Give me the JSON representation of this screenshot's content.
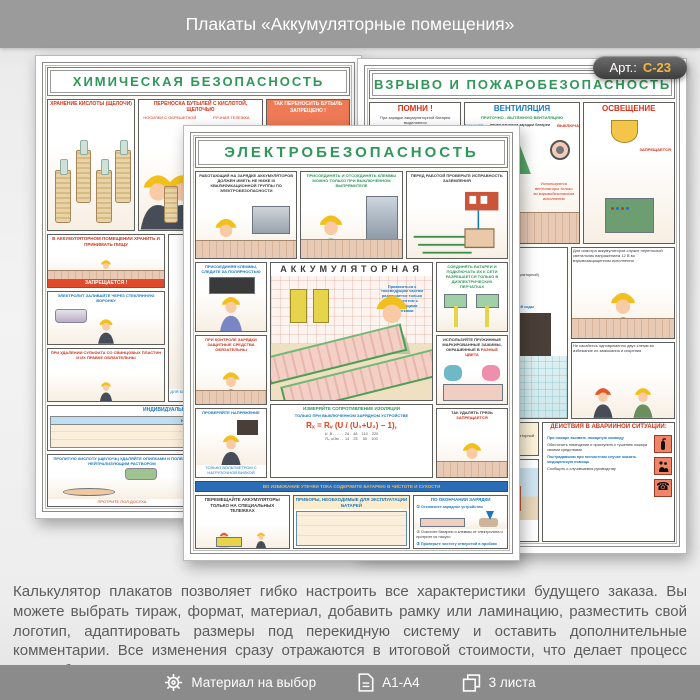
{
  "header": {
    "title": "Плакаты «Аккумуляторные помещения»"
  },
  "badge": {
    "prefix": "Арт.:",
    "code": "С-23"
  },
  "description": {
    "text": "Калькулятор плакатов позволяет гибко настроить все характеристики будущего заказа. Вы можете выбрать тираж, формат, материал, добавить рамку или ламинацию, разместить свой логотип, адаптировать размеры под перекидную систему и оставить дополнительные комментарии. Все изменения сразу отражаются в итоговой стоимости, что делает процесс заказа быстрым и прозрачным"
  },
  "footer": {
    "items": [
      {
        "icon": "gear-icon",
        "label": "Материал на выбор"
      },
      {
        "icon": "page-icon",
        "label": "А1-А4"
      },
      {
        "icon": "sheets-icon",
        "label": "3 листа"
      }
    ]
  },
  "posters": {
    "chemical": {
      "title": "ХИМИЧЕСКАЯ БЕЗОПАСНОСТЬ",
      "storage": {
        "title": "ХРАНЕНИЕ КИСЛОТЫ (ЩЕЛОЧИ)"
      },
      "carry": {
        "title": "ПЕРЕНОСКА БУТЫЛЕЙ С КИСЛОТОЙ, ЩЕЛОЧЬЮ",
        "sub1": "НОСИЛКИ С ОБРЕШЕТКОЙ",
        "sub2": "РУЧНАЯ ТЕЛЕЖКА"
      },
      "forbidden_carry": {
        "title": "ТАК ПЕРЕНОСИТЬ БУТЫЛЬ",
        "warn": "ЗАПРЕЩЕНО !"
      },
      "no_food": {
        "title": "В АККУМУЛЯТОРНОМ ПОМЕЩЕНИИ ХРАНИТЬ И ПРИНИМАТЬ ПИЩУ",
        "warn": "ЗАПРЕЩАЕТСЯ !"
      },
      "funnel": {
        "title": "ЭЛЕКТРОЛИТ ЗАЛИВАЙТЕ ЧЕРЕЗ СТЕКЛЯННУЮ ВОРОНКУ"
      },
      "sulfate": {
        "title": "ПРИ УДАЛЕНИИ СУЛЬФАТА СО СВИНЦОВЫХ ПЛАСТИН И ИХ ПРАВКЕ ОБЯЗАТЕЛЬНЫ"
      },
      "electrolyte": {
        "title": "ПРИГОТОВЛЕНИЕ ЭЛЕКТРОЛИТА",
        "sub": "КИСЛОТНОГО",
        "note": "ДЛЯ БЕЗОПАСНОГО СЛИВА КИСЛОТЫ (ЩЕЛОЧИ) ИСПОЛЬЗУЙТЕ СИФОН ИЛИ ПОДСТАВКУ ДЛЯ НАКЛОНА БУТЫЛИ"
      },
      "ppe": {
        "title": "ИНДИВИДУАЛЬНЫЕ ЗАЩИТНЫЕ СРЕДСТВА",
        "col": "НАИМЕНОВАНИЕ"
      },
      "spill": {
        "title": "ПРОЛИТУЮ КИСЛОТУ (ЩЕЛОЧЬ) УДАЛЯЙТЕ ОПИЛКАМИ И ПОЛЕЙТЕ НЕЙТРАЛИЗУЮЩИМ РАСТВОРОМ",
        "note": "ПРОТРИТЕ ПОЛ ДОСУХА"
      },
      "waste": {
        "title": "ОТРАБОТАННЫЙ ЭЛЕКТРОЛИТ СЛИВАЙТЕ В СПЕЦИАЛЬНУЮ ЕМКОСТЬ И ОТПРАВЬТЕ НА НЕЙТРАЛИЗАЦИЮ"
      }
    },
    "fire": {
      "title": "ВЗРЫВО И ПОЖАРОБЕЗОПАСНОСТЬ",
      "remember": {
        "title": "ПОМНИ !",
        "text": "При зарядке аккумуляторной батареи выделяются",
        "cloud1": "Вредные пары серной кислоты",
        "cloud2": "ВОДОРОД"
      },
      "ventilation": {
        "title": "ВЕНТИЛЯЦИЯ",
        "line1": "ПРИТОЧНО - ВЫТЯЖНУЮ ВЕНТИЛЯЦИЮ",
        "on": "ВКЛЮЧАЮТ",
        "when_on": "перед началом зарядки батареи",
        "off": "ВЫКЛЮЧАЮТ",
        "note": "Используются вентиляторы только во взрывобезопасном исполнении"
      },
      "lighting": {
        "title": "ОСВЕЩЕНИЕ",
        "warn": "ЗАПРЕЩАЕТСЯ"
      },
      "room": {
        "title": "АККУМУЛЯТОРНОЕ ПОМЕЩЕНИЕ",
        "items": [
          "1. Аккумуляторная",
          "2. Тамбур площадью не менее 1,5 м²",
          "3. Выключатель (располагается вне аккумуляторной)",
          "4. Кран с раковиной"
        ],
        "supplies": [
          "Мыло",
          "Вата 100 г",
          "Раствор борной кислоты",
          "Раствор питьевой соды"
        ]
      },
      "lamp": {
        "text": "Для осмотра аккумуляторов служит переносной светильник напряжением 12 В во взрывозащищенном исполнении"
      },
      "terminals": {
        "text": "Не касайтесь одновременно двух клемм во избежание их замыкания и искрения"
      },
      "door": {
        "text": "Дверь снабжается самозакрывающимся замком, который со стороны аккумуляторной открывается без ключа"
      },
      "windows": {
        "title": "Окна в аккумуляторной должны быть закрыты",
        "lead": "Летом для проветривания окна можно открыть, если:",
        "items": [
          "наружный воздух не запылен и не загрязнен отходами химических производств",
          "этажом выше нет других помещений"
        ]
      },
      "emergency": {
        "title": "ДЕЙСТВИЯ В АВАРИЙНОЙ СИТУАЦИИ:",
        "items": [
          "При пожаре вызвать пожарную команду",
          "Обесточить помещение и приступить к тушению пожара своими средствами",
          "Пострадавшим при несчастном случае оказать медицинскую помощь",
          "Сообщить о случившемся руководству"
        ]
      }
    },
    "electrical": {
      "title": "ЭЛЕКТРОБЕЗОПАСНОСТЬ",
      "qualification": {
        "title": "РАБОТАЮЩИЙ НА ЗАРЯДКЕ АККУМУЛЯТОРОВ ДОЛЖЕН ИМЕТЬ НЕ НИЖЕ III КВАЛИФИКАЦИОННОЙ ГРУППЫ ПО ЭЛЕКТРОБЕЗОПАСНОСТИ"
      },
      "clamps_off": {
        "title": "ПРИСОЕДИНЯТЬ И ОТСОЕДИНЯТЬ КЛЕММЫ МОЖНО ТОЛЬКО ПРИ ВЫКЛЮЧЕННОМ ВЫПРЯМИТЕЛЕ"
      },
      "grounding": {
        "title": "ПЕРЕД РАБОТОЙ ПРОВЕРЬТЕ ИСПРАВНОСТЬ ЗАЗЕМЛЕНИЯ"
      },
      "polarity": {
        "title": "ПРИСОЕДИНЯЯ КЛЕММЫ, СЛЕДИТЕ ЗА ПОЛЯРНОСТЬЮ"
      },
      "ppe_control": {
        "title": "ПРИ КОНТРОЛЕ ЗАРЯДКИ ЗАЩИТНЫЕ СРЕДСТВА ОБЯЗАТЕЛЬНЫ"
      },
      "voltage": {
        "title": "ПРОВЕРЯЙТЕ НАПРЯЖЕНИЕ",
        "note": "ТОЛЬКО ВОЛЬТМЕТРОМ С НАГРУЗОЧНОЙ ВИЛКОЙ"
      },
      "gloves": {
        "title": "СОЕДИНЯТЬ БАТАРЕИ И ПОДКЛЮЧАТЬ ИХ К СЕТИ РАЗРЕШАЕТСЯ ТОЛЬКО В ДИЭЛЕКТРИЧЕСКИХ ПЕРЧАТКАХ"
      },
      "clips": {
        "title": "ИСПОЛЬЗУЙТЕ ПРУЖИННЫЕ МАРКИРОВАННЫЕ ЗАЖИМЫ, ОКРАШЕННЫЕ В",
        "accent": "РАЗНЫЕ ЦВЕТА"
      },
      "dirt": {
        "title": "ТАК УДАЛЯТЬ ГРЯЗЬ",
        "warn": "ЗАПРЕЩАЕТСЯ"
      },
      "inset": {
        "title": "АККУМУЛЯТОРНАЯ",
        "note": "Прикасаться к токоведущим частям разрешается только инструментом с изолирующими рукоятками"
      },
      "resistance": {
        "title": "ИЗМЕРЯЙТЕ СОПРОТИВЛЕНИЕ ИЗОЛЯЦИИ",
        "sub": "ТОЛЬКО ПРИ ВЫКЛЮЧЕННОМ ЗАРЯДНОМ УСТРОЙСТВЕ",
        "formula": "Rₓ = Rᵥ (U / (U₁+U₂) − 1),",
        "row1": "U, В . . . . .  24    48    110    220",
        "row2": "Rₓ, кОм . .  14    25     50    100"
      },
      "band": {
        "text": "ВО ИЗБЕЖАНИЕ УТЕЧКИ ТОКА СОДЕРЖИТЕ БАТАРЕЮ В ЧИСТОТЕ И СУХОСТИ"
      },
      "trolley": {
        "title": "ПЕРЕМЕЩАЙТЕ АККУМУЛЯТОРЫ ТОЛЬКО НА СПЕЦИАЛЬНЫХ ТЕЛЕЖКАХ"
      },
      "devices": {
        "title": "ПРИБОРЫ, НЕОБХОДИМЫЕ ДЛЯ ЭКСПЛУАТАЦИИ БАТАРЕЙ"
      },
      "after": {
        "title": "ПО ОКОНЧАНИИ ЗАРЯДКИ",
        "steps": [
          "① Отключите зарядное устройство",
          "② Очистите батарею и клеммы от электролита и протрите их насухо",
          "③ Проверьте чистоту отверстий в пробках"
        ]
      }
    }
  }
}
